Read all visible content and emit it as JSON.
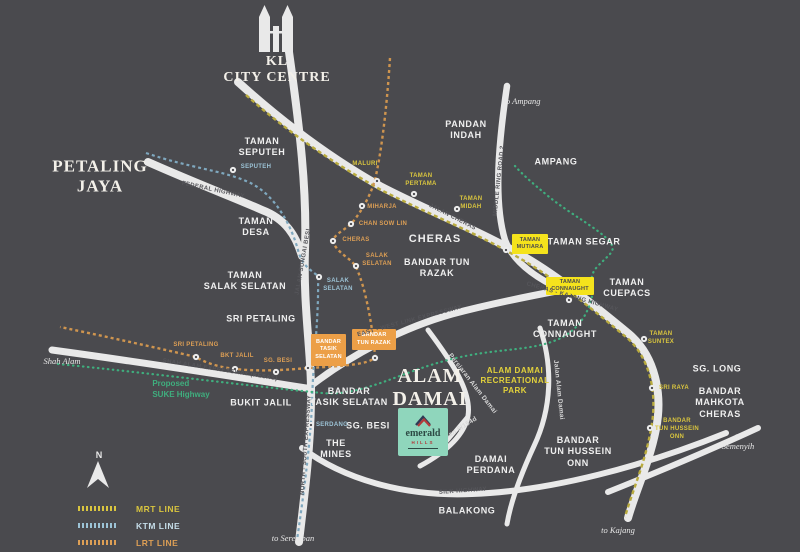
{
  "title": {
    "city": "KL\nCITY CENTRE"
  },
  "compass": {
    "label": "N"
  },
  "colors": {
    "background": "#4a4a4e",
    "road": "#e9e9e9",
    "mrt_line": "#b9ab3e",
    "ktm_line": "#7fa8bf",
    "lrt_line": "#cf954f",
    "suke_line": "#3fae7e",
    "yellow_box": "#f5e31c",
    "orange_box": "#ec9f47",
    "emerald_bg": "#8fd6bc"
  },
  "places": {
    "petaling_jaya": "PETALING\nJAYA",
    "taman_seputeh": "TAMAN\nSEPUTEH",
    "pandan_indah": "PANDAN\nINDAH",
    "ampang": "AMPANG",
    "taman_desa": "TAMAN\nDESA",
    "cheras": "CHERAS",
    "bandar_tun_razak": "BANDAR TUN\nRAZAK",
    "taman_salak_selatan": "TAMAN\nSALAK SELATAN",
    "taman_segar": "TAMAN SEGAR",
    "taman_cuepacs": "TAMAN\nCUEPACS",
    "sri_petaling": "SRI PETALING",
    "taman_connaught": "TAMAN\nCONNAUGHT",
    "sg_long": "SG. LONG",
    "bandar_mahkota_cheras": "BANDAR\nMAHKOTA\nCHERAS",
    "alam_damai": "ALAM\nDAMAI",
    "recreational_park": "ALAM DAMAI\nRECREATIONAL\nPARK",
    "bandar_tasik_selatan": "BANDAR\nTASIK SELATAN",
    "bukit_jalil": "BUKIT JALIL",
    "the_mines": "THE\nMINES",
    "sg_besi": "SG. BESI",
    "damai_perdana": "DAMAI\nPERDANA",
    "bandar_tun_hussein_onn": "BANDAR\nTUN HUSSEIN\nONN",
    "balakong": "BALAKONG"
  },
  "stations": {
    "mrt": {
      "maluri": "MALURI",
      "taman_pertama": "TAMAN\nPERTAMA",
      "taman_midah": "TAMAN\nMIDAH",
      "taman_suntex": "TAMAN\nSUNTEX",
      "sri_raya": "SRI RAYA",
      "bandar_tun_hussein_onn": "BANDAR\nTUN HUSSEIN\nONN"
    },
    "lrt": {
      "miharja": "MIHARJA",
      "chan_sow_lin": "CHAN SOW LIN",
      "cheras": "CHERAS",
      "salak_selatan": "SALAK\nSELATAN",
      "sri_petaling": "SRI PETALING",
      "bkt_jalil": "BKT JALIL",
      "sg_besi": "SG. BESI"
    },
    "ktm": {
      "seputeh": "SEPUTEH",
      "salak_selatan": "SALAK\nSELATAN",
      "serdang": "SERDANG"
    },
    "boxes": {
      "taman_mutiara": "TAMAN\nMUTIARA",
      "taman_connaught": "TAMAN\nCONNAUGHT",
      "bandar_tasik_selatan": "BANDAR\nTASIK\nSELATAN",
      "bandar_tun_razak": "BANDAR\nTUN RAZAK"
    }
  },
  "roads": {
    "federal": "FEDERAL HIGHWAY",
    "jalan_sungai_besi": "JALAN SUNGAI BESI",
    "jalan_cheras": "JALAN CHERAS",
    "mrr2": "MIDDLE RING ROAD 2",
    "east_west": "EAST - WEST LINK EXPRESSWAY",
    "cheras_kajang": "CHERAS - KAJANG HIGHWAY",
    "kesas": "SHAH ALAM EXPRESSWAY (KESAS)",
    "north_south": "NORTH - SOUTH EXPRESSWAY",
    "silk": "SILK HIGHWAY",
    "persiaran_alam_damai": "Persiaran Alam Damai",
    "jalan_alam_damai": "Jalan Alam Damai",
    "jalan_6154d": "Jalan 6/154d"
  },
  "directions": {
    "ampang": "to Ampang",
    "shah_alam": "to\nShah Alam",
    "seremban": "to Seremban",
    "kajang": "to Kajang",
    "semenyih": "to\nSemenyih"
  },
  "notes": {
    "suke": "Proposed\nSUKE Highway"
  },
  "project": {
    "name": "emerald",
    "sub": "HILLS"
  },
  "legend": {
    "items": [
      {
        "label": "MRT LINE",
        "color": "#d9c53f"
      },
      {
        "label": "KTM LINE",
        "color": "#c5dde9"
      },
      {
        "label": "LRT LINE",
        "color": "#dd9f55"
      }
    ]
  }
}
